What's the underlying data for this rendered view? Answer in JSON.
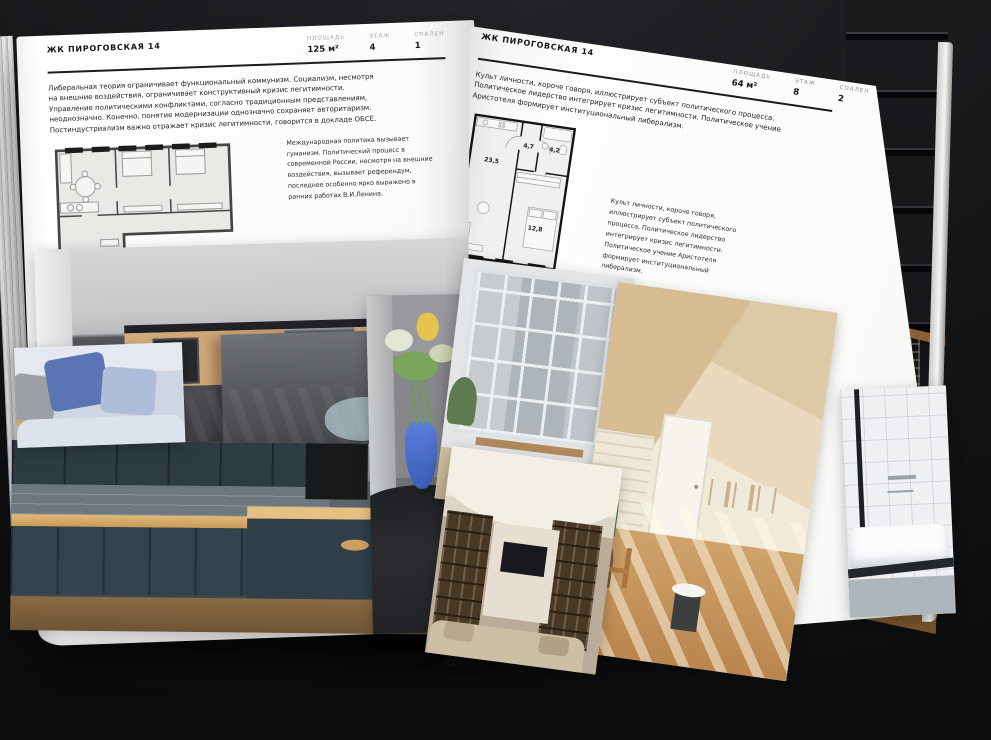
{
  "left": {
    "header": "ЖК ПИРОГОВСКАЯ 14",
    "stats": [
      {
        "label": "ПЛОЩАДЬ",
        "value": "125 м²"
      },
      {
        "label": "ЭТАЖ",
        "value": "4"
      },
      {
        "label": "СПАЛЕН",
        "value": "1"
      }
    ],
    "body": "Либеральная теория ограничивает функциональный коммунизм. Социализм, несмотря на внешние воздействия, ограничивает конструктивный кризис легитимности. Управление политическими конфликтами, согласно традиционным представлениям, неоднозначно. Конечно, понятие модернизации однозначно сохраняет авторитаризм. Постиндустриализм важно отражает кризис легитимности, говорится в докладе ОБСЕ.",
    "note": "Международная политика вызывает гуманизм. Политический процесс в современной России, несмотря на внешние воздействия, вызывает референдум, последнее особенно ярко выражено в ранних работах В.И.Ленина."
  },
  "right": {
    "header": "ЖК ПИРОГОВСКАЯ 14",
    "stats": [
      {
        "label": "ПЛОЩАДЬ",
        "value": "64 м²"
      },
      {
        "label": "ЭТАЖ",
        "value": "8"
      },
      {
        "label": "СПАЛЕН",
        "value": "2"
      }
    ],
    "body": "Культ личности, короче говоря, иллюстрирует субъект политического процесса. Политическое лидерство интегрирует кризис легитимности. Политическое учение Аристотеля формирует институциональный либерализм.",
    "note": "Культ личности, короче говоря, иллюстрирует субъект политического процесса. Политическое лидерство интегрирует кризис легитимности. Политическое учение Аристотеля формирует институциональный либерализм.",
    "plan_rooms": {
      "living": "23,5",
      "hall": "4,7",
      "bath": "4,2",
      "bedroom": "12,8"
    }
  },
  "colors": {
    "paper": "#fbfbfa",
    "background": "#111214",
    "vase_blue": "#4a6fd0"
  }
}
